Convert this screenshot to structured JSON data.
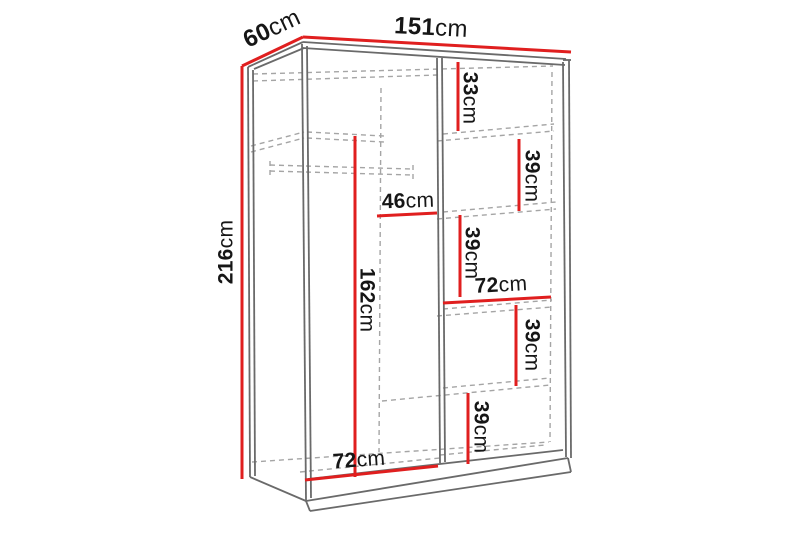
{
  "diagram": {
    "type": "furniture-dimension-diagram",
    "subject": "sliding-door wardrobe with shelves and hanging rail, perspective line drawing",
    "unit": "cm",
    "colors": {
      "dimension_line": "#e01f1f",
      "outline": "#6a6a6a",
      "hidden_line": "#a5a5a5",
      "label_text": "#161616",
      "background": "#ffffff"
    },
    "overall": {
      "width_cm": 151,
      "depth_cm": 60,
      "height_cm": 216
    },
    "dims": [
      {
        "id": "depth-top",
        "value": "60",
        "unit": "cm"
      },
      {
        "id": "width-top",
        "value": "151",
        "unit": "cm"
      },
      {
        "id": "height-left",
        "value": "216",
        "unit": "cm"
      },
      {
        "id": "right-gap-top",
        "value": "33",
        "unit": "cm"
      },
      {
        "id": "right-gap-2",
        "value": "39",
        "unit": "cm"
      },
      {
        "id": "interior-depth",
        "value": "46",
        "unit": "cm"
      },
      {
        "id": "right-gap-3",
        "value": "39",
        "unit": "cm"
      },
      {
        "id": "right-shelf-width",
        "value": "72",
        "unit": "cm"
      },
      {
        "id": "hanging-height",
        "value": "162",
        "unit": "cm"
      },
      {
        "id": "right-gap-4",
        "value": "39",
        "unit": "cm"
      },
      {
        "id": "right-gap-5",
        "value": "39",
        "unit": "cm"
      },
      {
        "id": "left-section-width",
        "value": "72",
        "unit": "cm"
      }
    ]
  }
}
